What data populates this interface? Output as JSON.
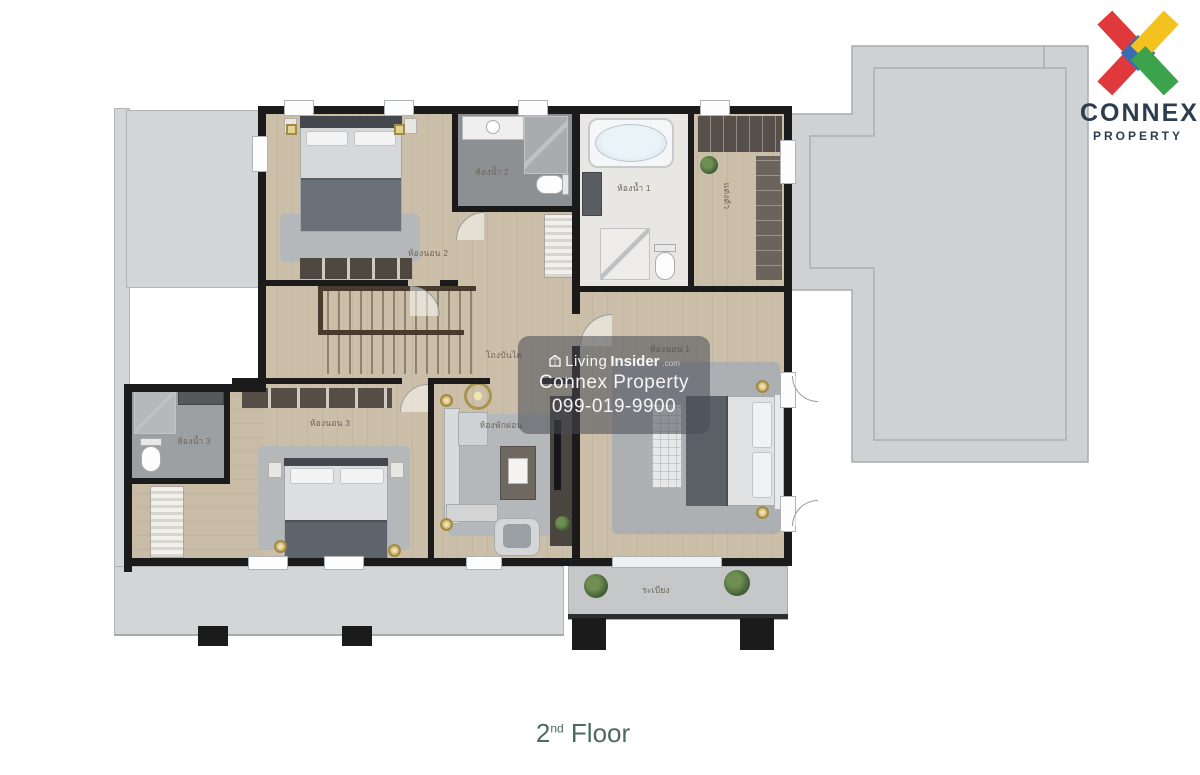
{
  "brand": {
    "name": "CONNEX",
    "tagline": "PROPERTY"
  },
  "watermark": {
    "prefix": "Living",
    "bold": "Insider",
    "tld": ".com",
    "company": "Connex Property",
    "phone": "099-019-9900"
  },
  "caption": {
    "number": "2",
    "suffix": "nd",
    "word": "Floor"
  },
  "rooms": {
    "bedroom2": "ห้องนอน 2",
    "bathroom2": "ห้องน้ำ 2",
    "bathroom1": "ห้องน้ำ 1",
    "dressing": "แต่งตัว",
    "stair_hall": "โถงบันได",
    "bedroom1": "ห้องนอน 1",
    "bathroom3": "ห้องน้ำ 3",
    "bedroom3": "ห้องนอน 3",
    "family": "ห้องพักผ่อน",
    "balcony": "ระเบียง"
  },
  "colors": {
    "logo_red": "#e0393b",
    "logo_yellow": "#f4c21f",
    "logo_green": "#3aa34c",
    "logo_blue": "#3b6cb3",
    "brand_navy": "#2c3d4f",
    "caption_green": "#4a6b5e",
    "wall_black": "#1b1b1b",
    "wood_floor": "#cbbfa9",
    "roof_gray": "#cfd1d3"
  }
}
